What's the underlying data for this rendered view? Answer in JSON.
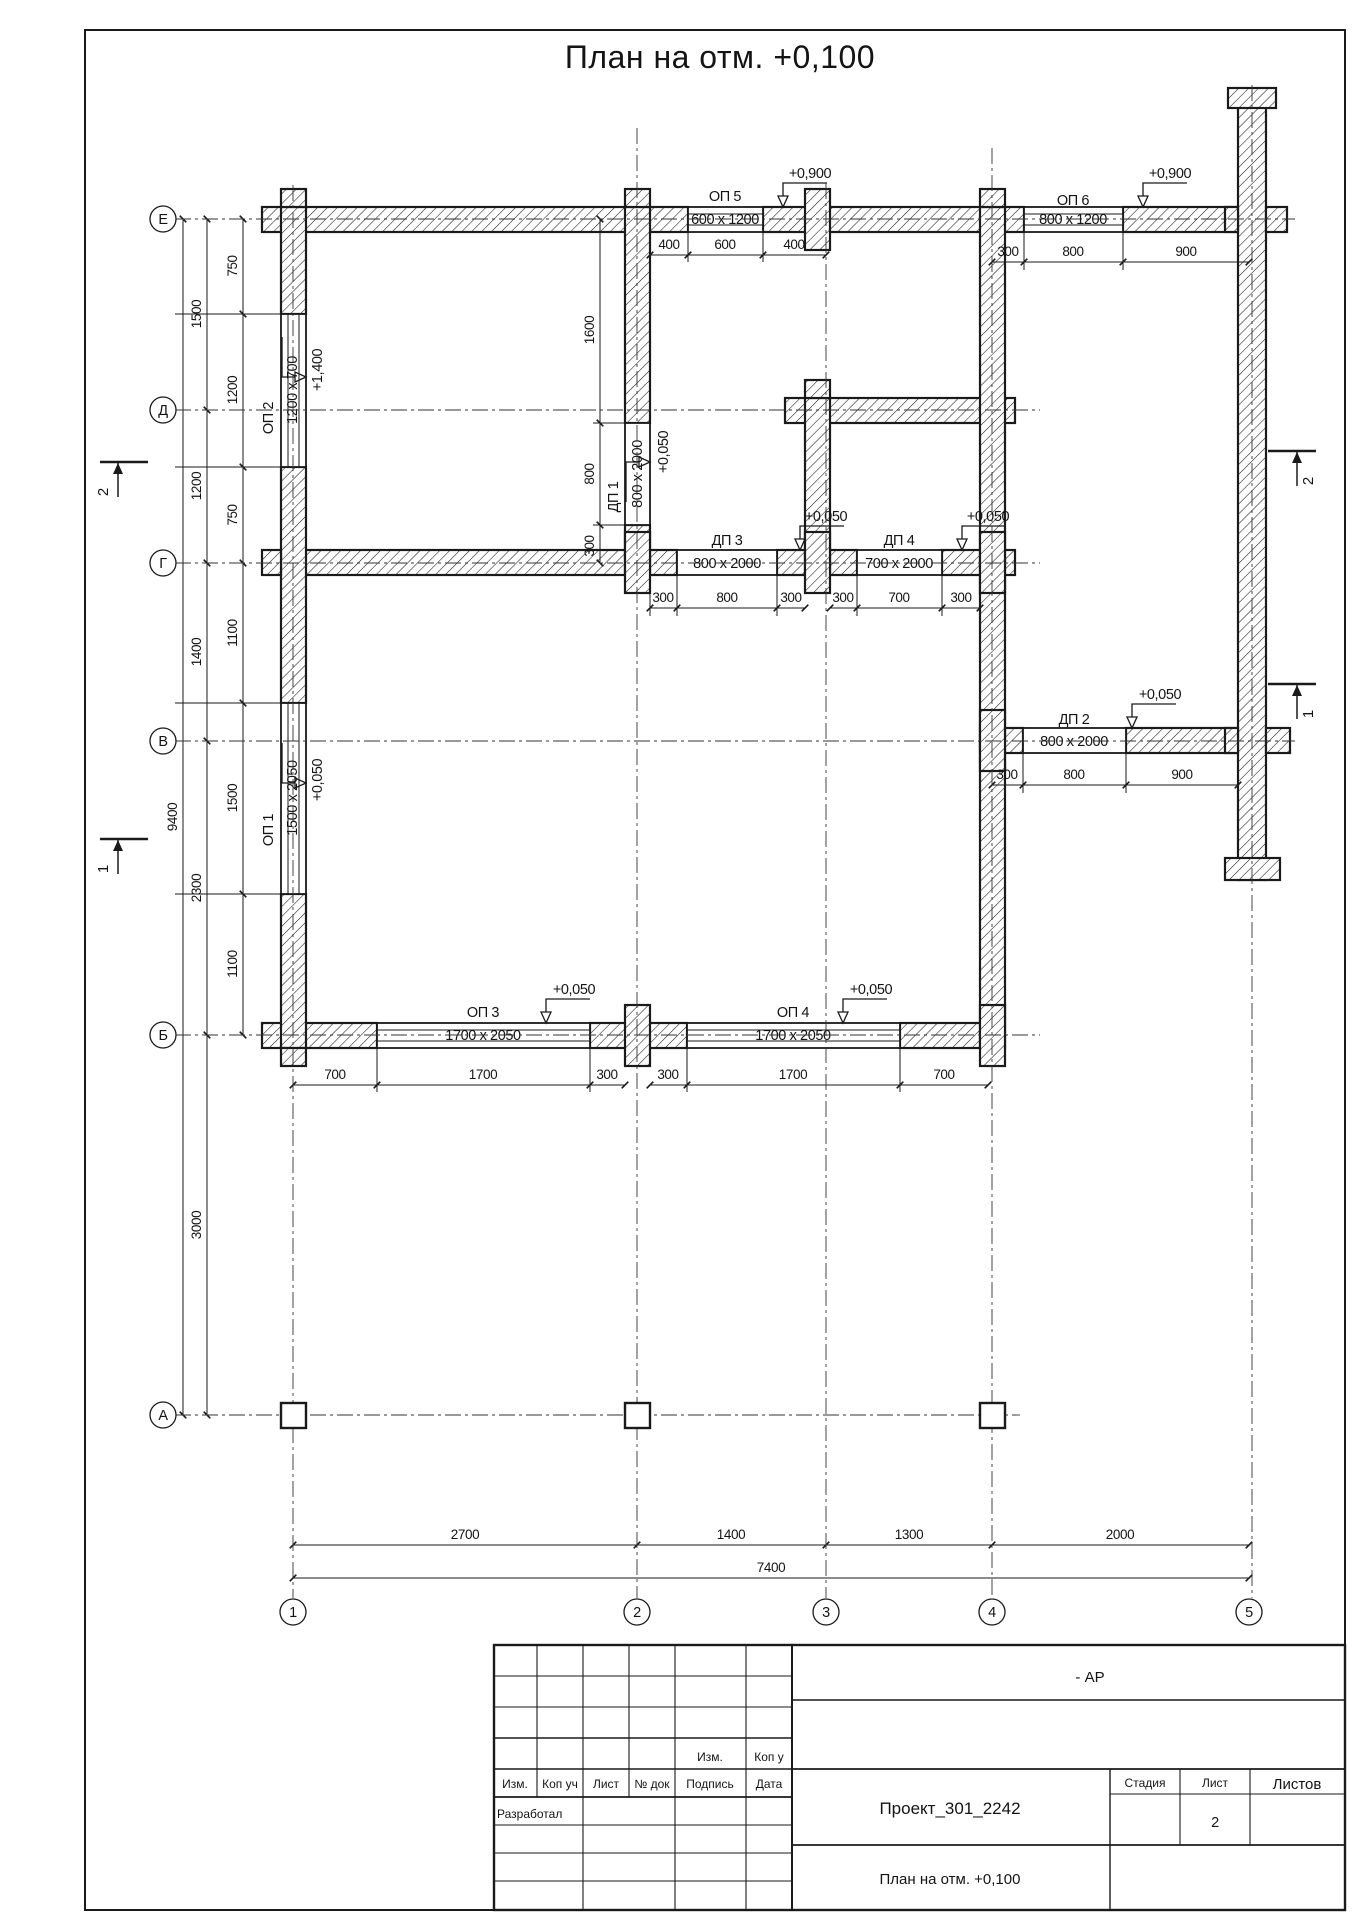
{
  "drawing": {
    "title": "План на отм. +0,100"
  },
  "axes": {
    "rows": [
      "Е",
      "Д",
      "Г",
      "В",
      "Б",
      "А"
    ],
    "cols": [
      "1",
      "2",
      "3",
      "4",
      "5"
    ]
  },
  "sections": {
    "s1": "1",
    "s2": "2"
  },
  "openings": {
    "op1": {
      "label": "ОП 1",
      "size": "1500 x 2050",
      "level": "+0,050"
    },
    "op2": {
      "label": "ОП 2",
      "size": "1200 x 700",
      "level": "+1,400"
    },
    "op3": {
      "label": "ОП 3",
      "size": "1700 x 2050",
      "level": "+0,050"
    },
    "op4": {
      "label": "ОП 4",
      "size": "1700 x 2050",
      "level": "+0,050"
    },
    "op5": {
      "label": "ОП 5",
      "size": "600 x 1200",
      "level": "+0,900"
    },
    "op6": {
      "label": "ОП 6",
      "size": "800 x 1200",
      "level": "+0,900"
    },
    "dp1": {
      "label": "ДП 1",
      "size": "800 x 2000",
      "level": "+0,050"
    },
    "dp2": {
      "label": "ДП 2",
      "size": "800 x 2000",
      "level": "+0,050"
    },
    "dp3": {
      "label": "ДП 3",
      "size": "800 x 2000",
      "level": "+0,050"
    },
    "dp4": {
      "label": "ДП 4",
      "size": "700 x 2000",
      "level": "+0,050"
    }
  },
  "dims": {
    "left_outer": [
      "1500",
      "1200",
      "1400",
      "2300",
      "3000"
    ],
    "left_inner": [
      "750",
      "1200",
      "750",
      "1100",
      "1500",
      "1100"
    ],
    "overall_left": "9400",
    "axis2": [
      "1600",
      "800",
      "300"
    ],
    "e_row_op5": [
      "400",
      "600",
      "400"
    ],
    "e_row_op6": [
      "300",
      "800",
      "900"
    ],
    "g_row": [
      "300",
      "800",
      "300",
      "300",
      "700",
      "300"
    ],
    "v_row": [
      "300",
      "800",
      "900"
    ],
    "b_row": [
      "700",
      "1700",
      "300",
      "300",
      "1700",
      "700"
    ],
    "bottom": [
      "2700",
      "1400",
      "1300",
      "2000"
    ],
    "bottom_total": "7400"
  },
  "title_block": {
    "doc_code": "- АР",
    "project": "Проект_301_2242",
    "drawing_title": "План на отм. +0,100",
    "stage_label": "Стадия",
    "sheet_label": "Лист",
    "sheets_label": "Листов",
    "sheet_number": "2",
    "developed": "Разработал",
    "header": {
      "izm": "Изм.",
      "kol": "Коп уч",
      "list": "Лист",
      "doc": "№ док",
      "sign": "Подпись",
      "date": "Дата"
    },
    "upper": {
      "izm": "Изм.",
      "kol": "Коп у"
    }
  }
}
